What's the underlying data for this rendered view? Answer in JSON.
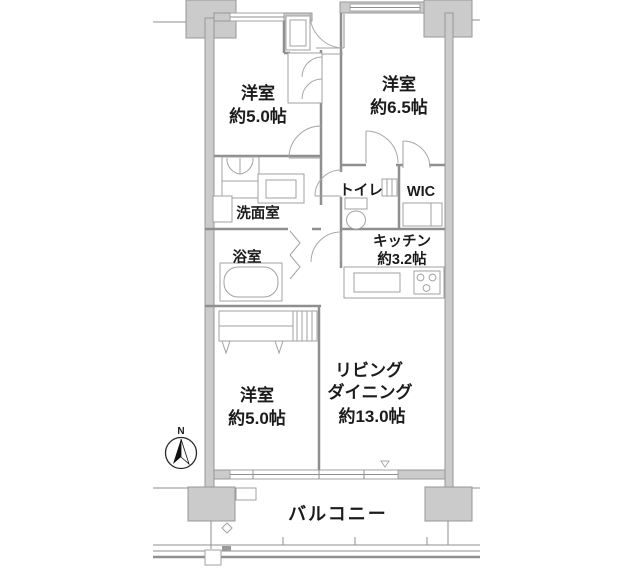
{
  "plan": {
    "rooms": {
      "bedroom1": {
        "name": "洋室",
        "size": "約5.0帖"
      },
      "bedroom2": {
        "name": "洋室",
        "size": "約6.5帖"
      },
      "toilet": {
        "name": "トイレ"
      },
      "wic": {
        "name": "WIC"
      },
      "washroom": {
        "name": "洗面室"
      },
      "bathroom": {
        "name": "浴室"
      },
      "kitchen": {
        "name": "キッチン",
        "size": "約3.2帖"
      },
      "bedroom3": {
        "name": "洋室",
        "size": "約5.0帖"
      },
      "living": {
        "line1": "リビング",
        "line2": "ダイニング",
        "size": "約13.0帖"
      },
      "balcony": {
        "name": "バルコニー"
      }
    },
    "compass": {
      "north_label": "N"
    },
    "colors": {
      "wall_fill": "#cbcbcb",
      "wall_stroke": "#979797",
      "partition_line": "#8f8f8f",
      "fixture_line": "#a2a2a2",
      "text": "#1b1b1b",
      "background": "#ffffff"
    }
  }
}
